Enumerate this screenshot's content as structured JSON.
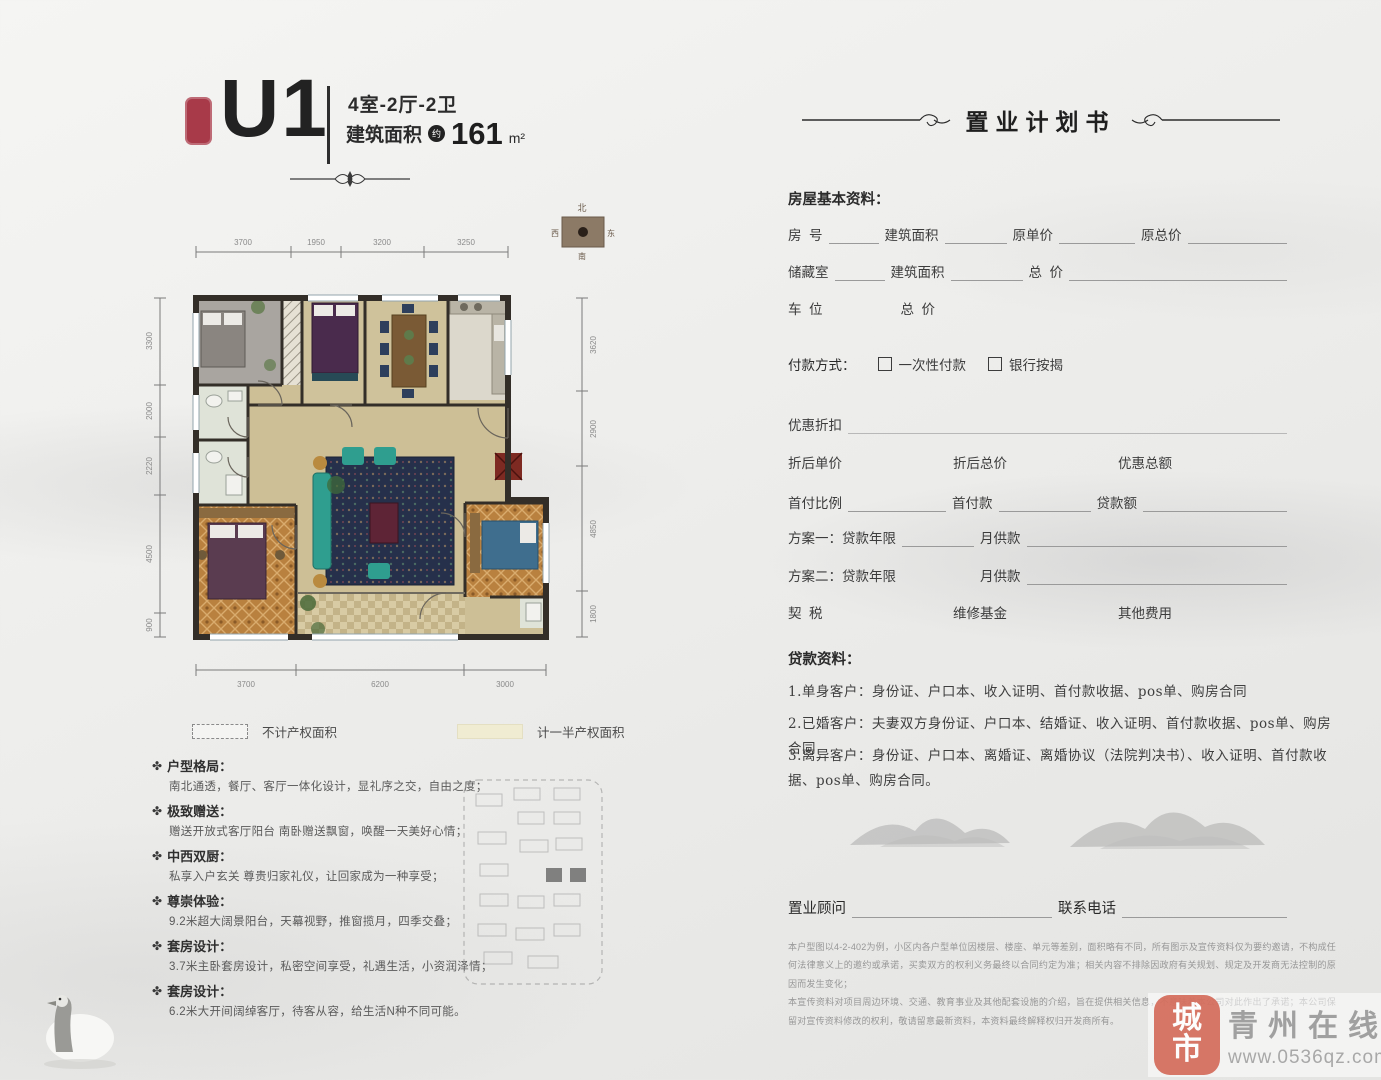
{
  "header": {
    "unit": "U1",
    "spec": "4室-2厅-2卫",
    "area_label": "建筑面积",
    "area_circle": "约",
    "area_value": "161",
    "area_unit": "m²"
  },
  "compass": {
    "north": "北",
    "south": "南",
    "east": "东",
    "west": "西"
  },
  "dims": {
    "top": [
      "3700",
      "1950",
      "3200",
      "3250"
    ],
    "bottom": [
      "3700",
      "6200",
      "3000"
    ],
    "left": [
      "3300",
      "2000",
      "2220",
      "4500",
      "900"
    ],
    "right": [
      "3620",
      "2900",
      "4850",
      "1800"
    ]
  },
  "legend": {
    "item1": "不计产权面积",
    "item2": "计一半产权面积"
  },
  "features": [
    {
      "title": "户型格局：",
      "desc": "南北通透，餐厅、客厅一体化设计，显礼序之交，自由之度；"
    },
    {
      "title": "极致赠送：",
      "desc": "赠送开放式客厅阳台 南卧赠送飘窗，唤醒一天美好心情；"
    },
    {
      "title": "中西双厨：",
      "desc": "私享入户玄关 尊贵归家礼仪，让回家成为一种享受；"
    },
    {
      "title": "尊崇体验：",
      "desc": "9.2米超大阔景阳台，天幕视野，推窗揽月，四季交叠；"
    },
    {
      "title": "套房设计：",
      "desc": "3.7米主卧套房设计，私密空间享受，礼遇生活，小资润泽情；"
    },
    {
      "title": "套房设计：",
      "desc": "6.2米大开间阔绰客厅，待客从容，给生活N种不同可能。"
    }
  ],
  "form": {
    "title": "置业计划书",
    "basic_title": "房屋基本资料：",
    "r1l1": "房  号",
    "r1l2": "建筑面积",
    "r1l3": "原单价",
    "r1l4": "原总价",
    "r2l1": "储藏室",
    "r2l2": "建筑面积",
    "r2l3": "总  价",
    "r3l1": "车  位",
    "r3l2": "总  价",
    "pay_label": "付款方式：",
    "pay_opt1": "一次性付款",
    "pay_opt2": "银行按揭",
    "discount": "优惠折扣",
    "d1": "折后单价",
    "d2": "折后总价",
    "d3": "优惠总额",
    "f1": "首付比例",
    "f2": "首付款",
    "f3": "贷款额",
    "plan1": "方案一：",
    "plan1a": "贷款年限",
    "plan1b": "月供款",
    "plan2": "方案二：",
    "plan2a": "贷款年限",
    "plan2b": "月供款",
    "fee1": "契  税",
    "fee2": "维修基金",
    "fee3": "其他费用",
    "loan_title": "贷款资料：",
    "loan1": "1.单身客户：身份证、户口本、收入证明、首付款收据、pos单、购房合同",
    "loan2": "2.已婚客户：夫妻双方身份证、户口本、结婚证、收入证明、首付款收据、pos单、购房合同",
    "loan3": "3.离异客户：身份证、户口本、离婚证、离婚协议（法院判决书）、收入证明、首付款收据、pos单、购房合同。",
    "consultant": "置业顾问",
    "phone": "联系电话",
    "disc1": "本户型图以4-2-402为例，小区内各户型单位因楼层、楼座、单元等差别，面积略有不同，所有图示及宣传资料仅为要约邀请，不构成任何法律意义上的邀约或承诺，买卖双方的权利义务最终以合同约定为准；相关内容不排除因政府有关规划、规定及开发商无法控制的原因而发生变化；",
    "disc2": "本宣传资料对项目周边环境、交通、教育事业及其他配套设施的介绍，旨在提供相关信息，不意味着本公司对此作出了承诺；本公司保留对宣传资料修改的权利，敬请留意最新资料，本资料最终解释权归开发商所有。"
  },
  "watermark": {
    "seal_top": "城",
    "seal_bottom": "市",
    "name": "青州在线",
    "url": "www.0536qz.com"
  },
  "colors": {
    "accent_red": "#a83a49",
    "wall": "#332e28",
    "floor": "#cdbf96",
    "carpet": "#b9813f",
    "sofa_teal": "#2f9e8f",
    "rug_navy": "#26304b",
    "watermark_red": "#d2614e"
  }
}
